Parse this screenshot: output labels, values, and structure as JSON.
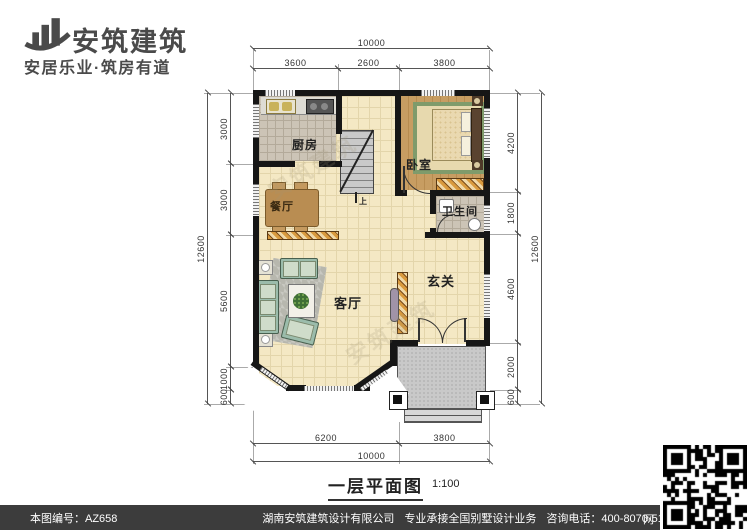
{
  "logo": {
    "brand": "安筑建筑",
    "tagline": "安居乐业·筑房有道",
    "icon": "building-bars-icon"
  },
  "plan": {
    "title": "一层平面图",
    "scale_note": "1:100",
    "stairs_up_label": "上",
    "watermark": "安筑建筑",
    "rooms": {
      "kitchen": "厨房",
      "bedroom": "卧室",
      "dining": "餐厅",
      "bathroom": "卫生间",
      "living": "客厅",
      "entry": "玄关"
    },
    "dims": {
      "top_total": "10000",
      "top": [
        "3600",
        "2600",
        "3800"
      ],
      "left_total": "12600",
      "left": [
        "3000",
        "3000",
        "5600",
        "1000",
        "600"
      ],
      "right_total": "12600",
      "right": [
        "4200",
        "1800",
        "4600",
        "2000",
        "600"
      ],
      "bottom": [
        "6200",
        "3800"
      ],
      "bottom_total": "10000"
    }
  },
  "footer": {
    "serial": "本图编号：AZ658",
    "company": "湖南安筑建筑设计有限公司",
    "service": "专业承接全国别墅设计业务",
    "hotline": "咨询电话：400-8070-511",
    "web": "网"
  },
  "colors": {
    "wall": "#161616",
    "floor_cream": "#f4e8c4",
    "footer_bar": "#3c3c3c",
    "logo_gray": "#4a4a4a"
  }
}
